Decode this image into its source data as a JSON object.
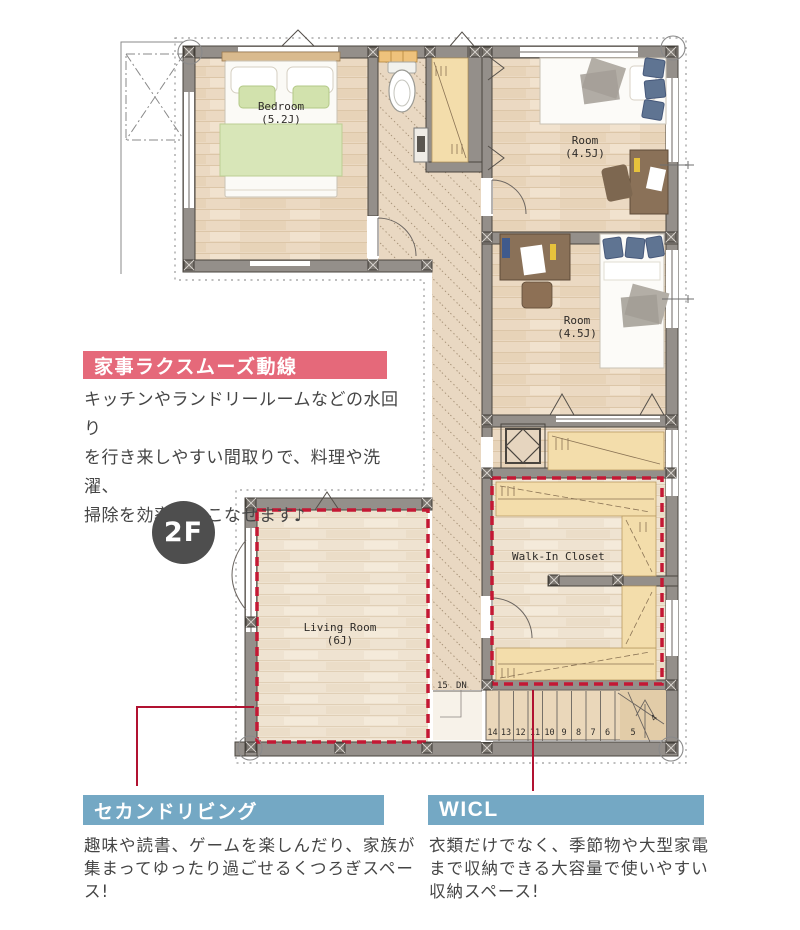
{
  "colors": {
    "accent_pink": "#e5697a",
    "accent_blue": "#74a8c4",
    "leader_red": "#b11231",
    "dash_red": "#c41834",
    "badge_gray": "#4e4e4e"
  },
  "floor_badge": {
    "label": "2F"
  },
  "callouts": {
    "kaji_title": "家事ラクスムーズ動線",
    "kaji_body": "キッチンやランドリールームなどの水回り\nを行き来しやすい間取りで、料理や洗濯、\n掃除を効率よくこなせます♪",
    "second_living_title": "セカンドリビング",
    "second_living_body": "趣味や読書、ゲームを楽しんだり、家族が\n集まってゆったり過ごせるくつろぎスペース!",
    "wicl_title": "WICL",
    "wicl_body": "衣類だけでなく、季節物や大型家電\nまで収納できる大容量で使いやすい\n収納スペース!"
  },
  "plan": {
    "bedroom_name": "Bedroom",
    "bedroom_size": "(5.2J)",
    "room1_name": "Room",
    "room1_size": "(4.5J)",
    "room2_name": "Room",
    "room2_size": "(4.5J)",
    "living_name": "Living Room",
    "living_size": "(6J)",
    "wic_name": "Walk-In Closet",
    "stair_landing": "15",
    "stair_dn": "DN",
    "stair_steps": [
      "14",
      "13",
      "12",
      "11",
      "10",
      "9",
      "8",
      "7",
      "6",
      "5",
      "4"
    ]
  }
}
